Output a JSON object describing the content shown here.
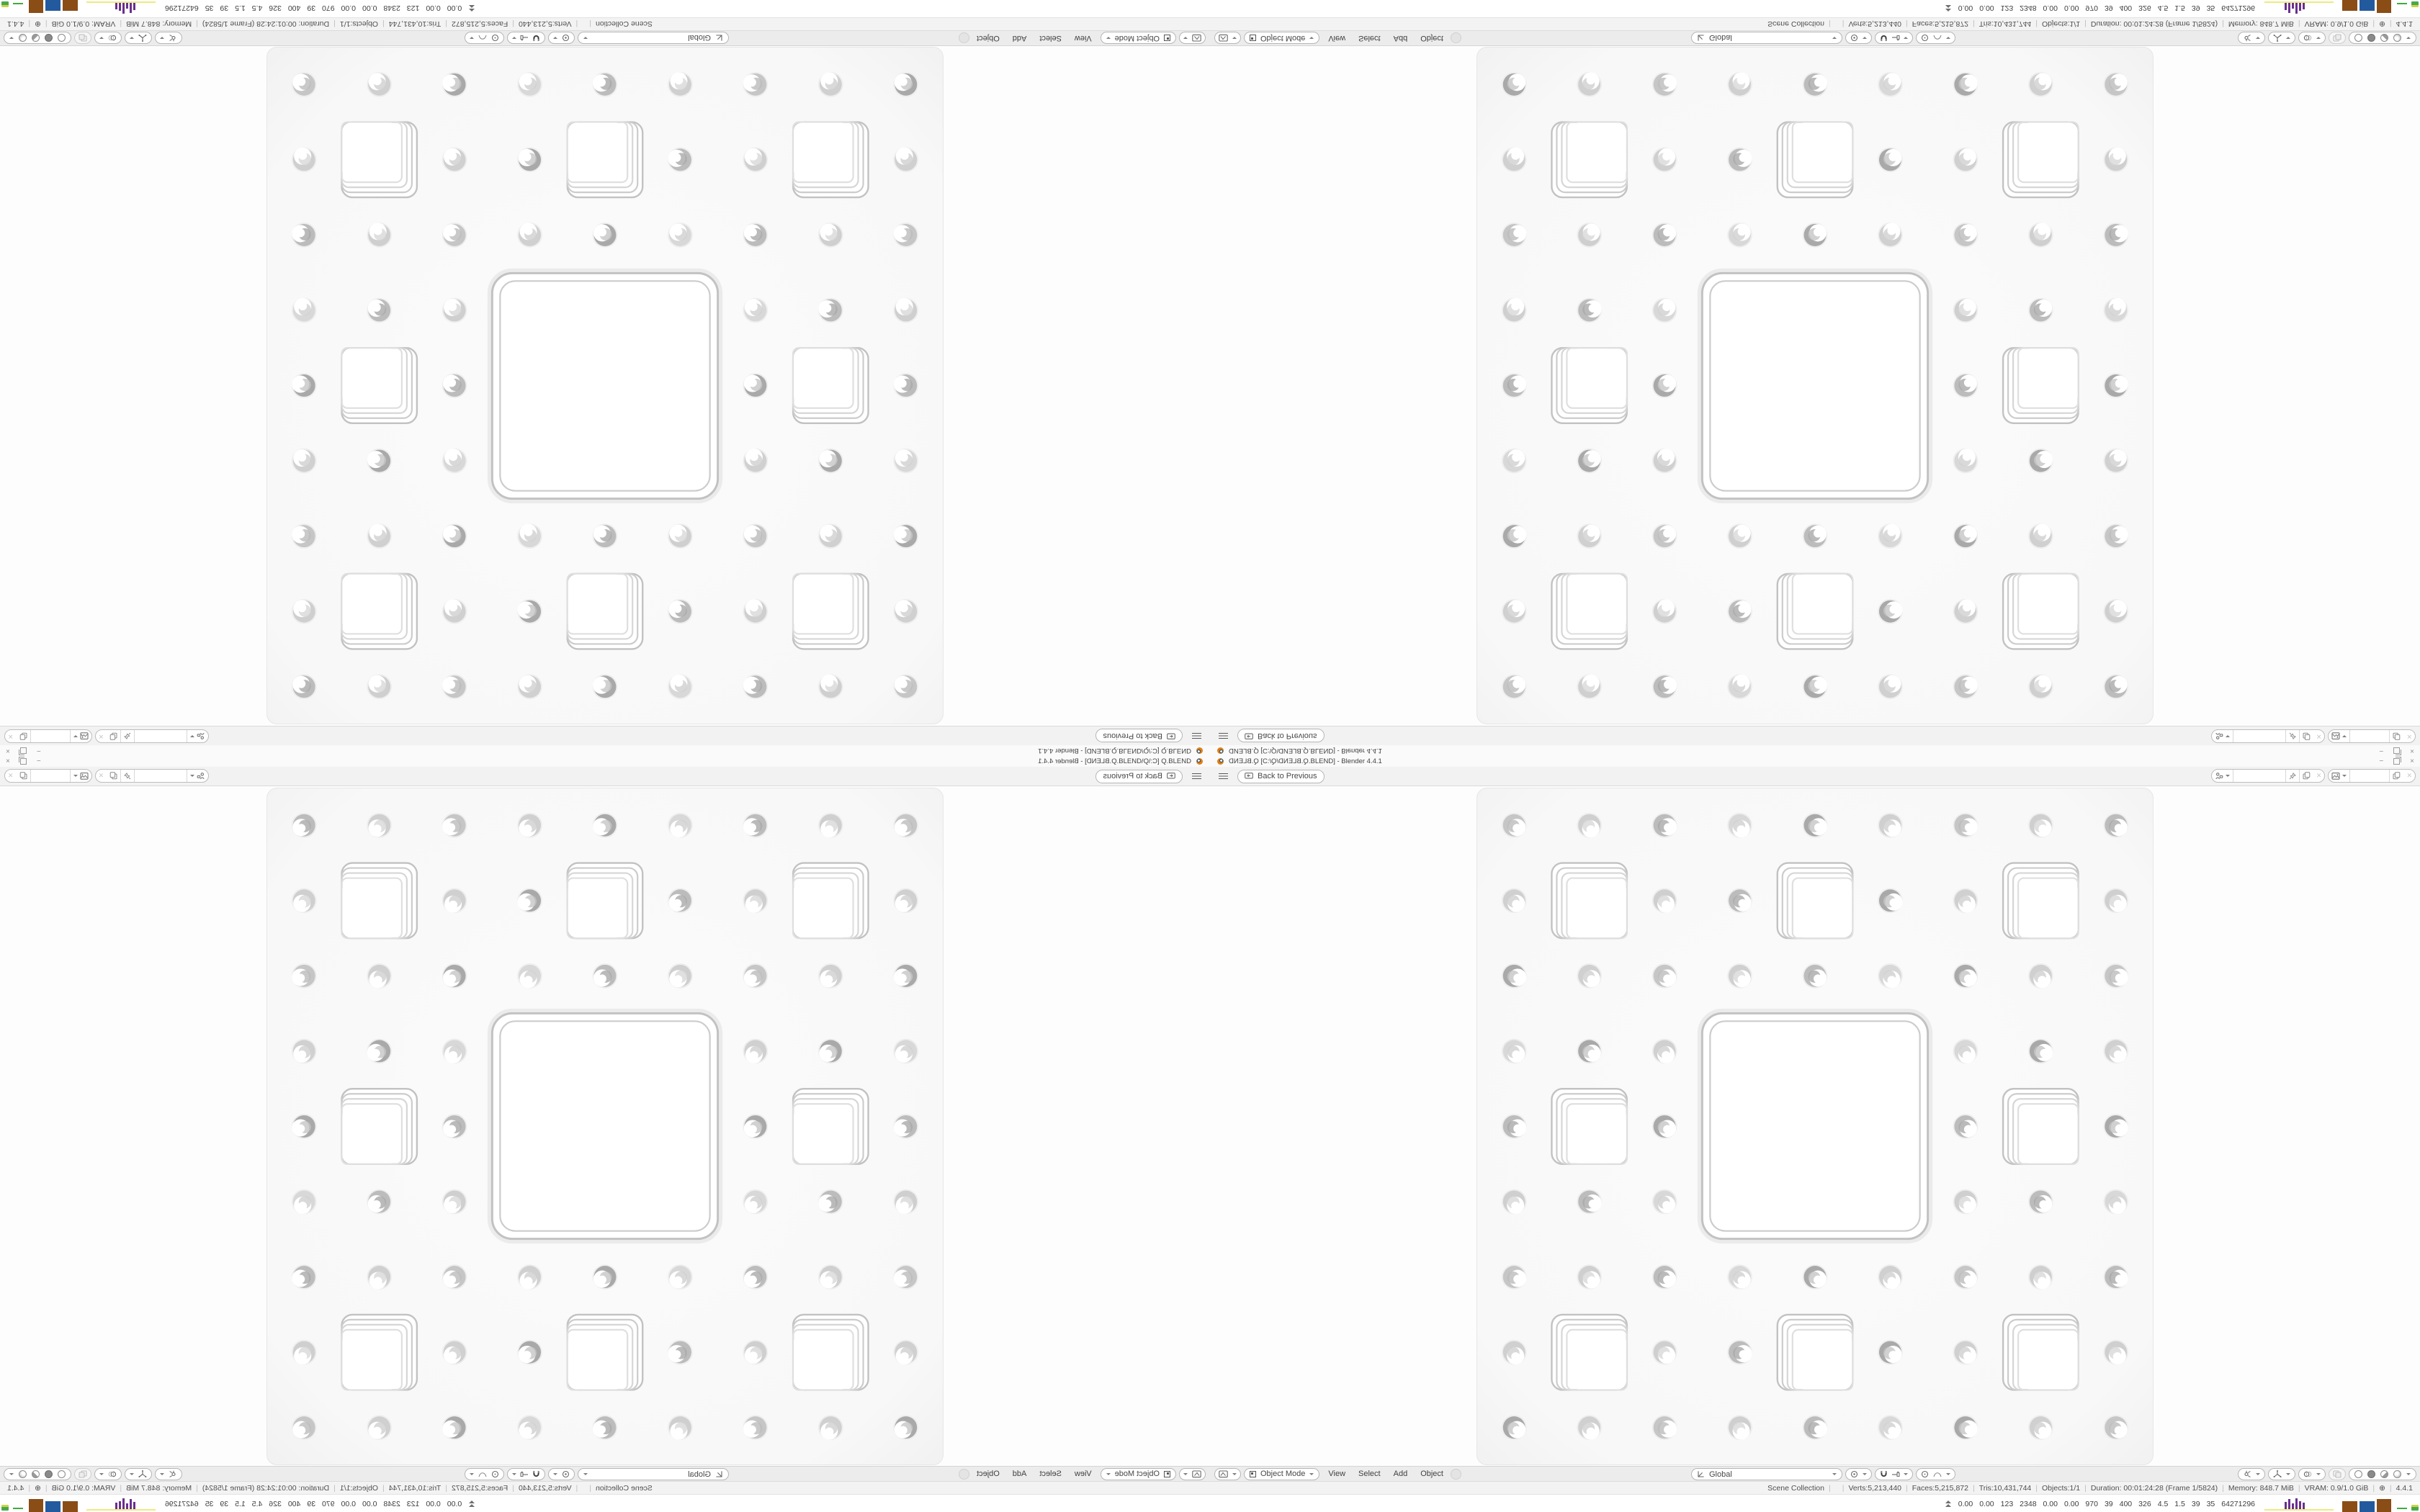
{
  "window": {
    "title": {
      "file_mirrored": "Q.BLEND",
      "path_open": " [C:\\",
      "folder_mirrored": "Q",
      "backslash": "\\",
      "path_close": ".BLEND] - Blender 4.4.1"
    },
    "controls": {
      "minimize": "−",
      "close": "×"
    }
  },
  "topbar": {
    "back_label": "Back to Previous"
  },
  "viewport_header": {
    "mode": "Object Mode",
    "menus": [
      "View",
      "Select",
      "Add",
      "Object"
    ],
    "orientation": "Global"
  },
  "status_bar": {
    "items": [
      "Scene Collection",
      "",
      "Verts:5,213,440",
      "Faces:5,215,872",
      "Tris:10,431,744",
      "Objects:1/1",
      "Duration: 00:01:24:28 (Frame 1/5824)",
      "Memory: 848.7 MiB",
      "VRAM: 0.9/1.0 GiB",
      "⊕",
      "4.4.1"
    ]
  },
  "system_overlay": {
    "values": [
      "0.00",
      "0.00",
      "123",
      "2348",
      "0.00",
      "0.00",
      "970",
      "39",
      "400",
      "326",
      "4.5",
      "1.5",
      "39",
      "35",
      "64271296"
    ],
    "purple_bar_heights": [
      10,
      14,
      8,
      15,
      11,
      9
    ],
    "colors": {
      "yellow": "#edea7e",
      "purple": "#6b2f8f",
      "brown": "#8a4d15",
      "blue": "#235a9e",
      "green": "#3faa3f"
    }
  },
  "sponge": {
    "background": "#f8f8f8",
    "edge": "#e6e6e6",
    "ring_grays": [
      "#c2c2c2",
      "#cccccc",
      "#d6d6d6",
      "#dfdfdf"
    ],
    "hole_palette": [
      "#c6c6c6",
      "#cfcfcf",
      "#bcbcbc",
      "#d8d8d8",
      "#a9a9a9",
      "#d0d0d0"
    ]
  }
}
